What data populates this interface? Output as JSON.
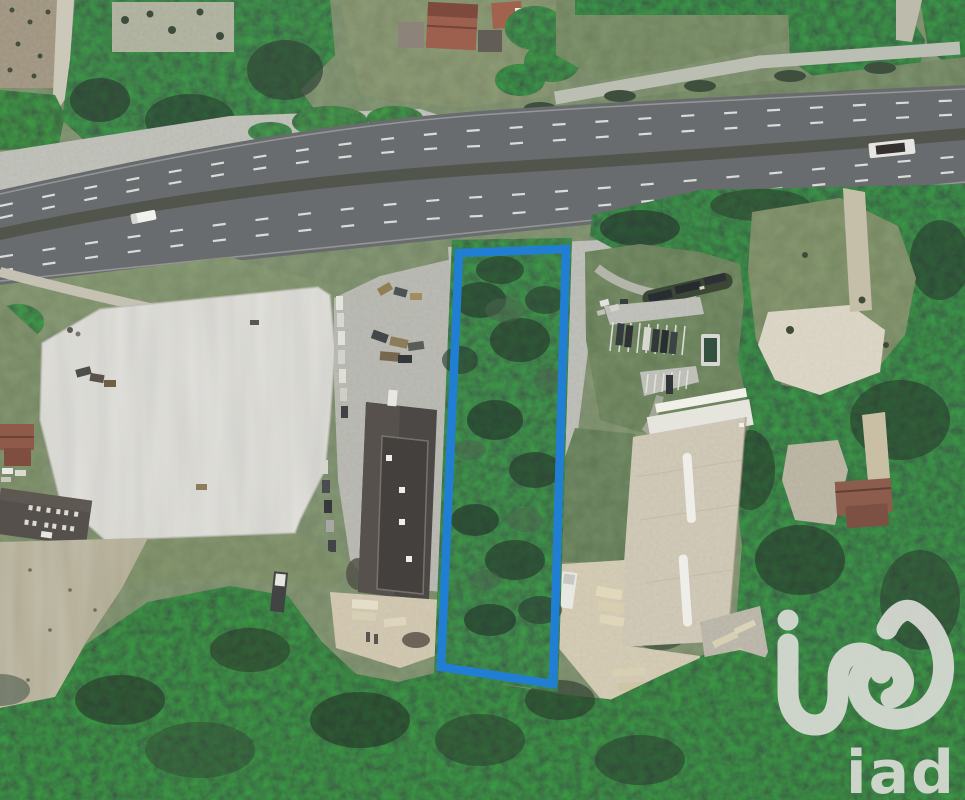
{
  "watermark": {
    "brand": "iad",
    "mark_icon": "iad-logo-mark",
    "color": "#d9dbd5"
  },
  "parcel": {
    "outline_color": "#1b7dd4",
    "outline_width": 8.5
  },
  "palette": {
    "asphalt": "#66696a",
    "median": "#4e5147",
    "forest": "#2e4034",
    "gravel_pit": "#d9d8d1",
    "dark_roof": "#47433f",
    "tan_roof": "#cdc3aa",
    "lawn": "#4f6542",
    "field": "#a59c73"
  }
}
